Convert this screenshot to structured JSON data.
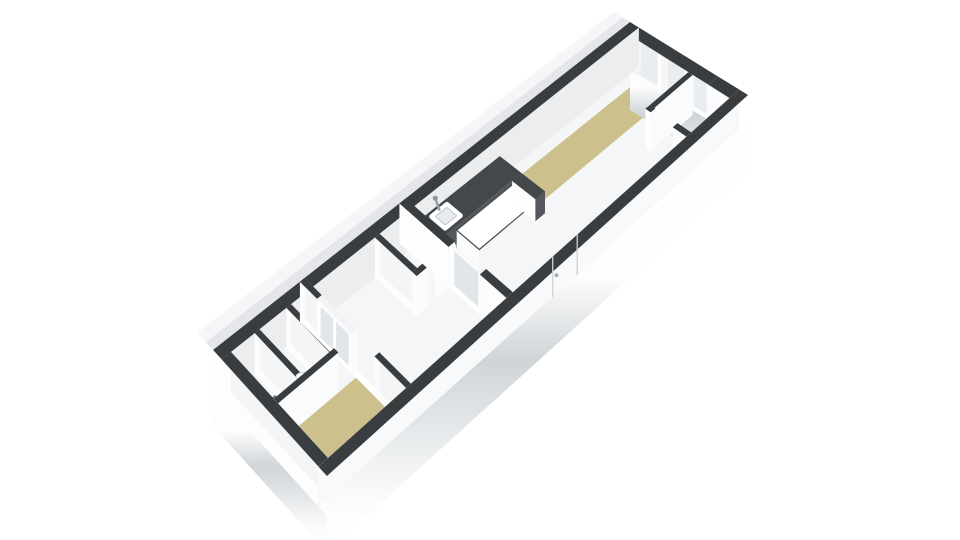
{
  "meta": {
    "view": "3d-floorplan-isometric",
    "background": "#ffffff"
  },
  "rooms": [
    {
      "name": "living-kitchen",
      "floor": "wood-strip-and-white",
      "features": [
        "kitchen-counter",
        "sink",
        "island",
        "glazed-door"
      ]
    },
    {
      "name": "end-room",
      "floor": "white"
    },
    {
      "name": "hallway",
      "floor": "white",
      "features": [
        "interior-window"
      ]
    },
    {
      "name": "wc-mid",
      "floor": "white"
    },
    {
      "name": "bedroom",
      "floor": "wood"
    },
    {
      "name": "bathroom",
      "floor": "white",
      "features": [
        "shower-tray",
        "radiator"
      ]
    },
    {
      "name": "wc-tip",
      "floor": "white",
      "features": [
        "toilet"
      ]
    }
  ],
  "colors": {
    "wall_top": "#3a3d40",
    "face_end": "#fdfdfe",
    "face_end2": "#f3f5f6",
    "face_se": "#fafbfc",
    "face_shade": "#ebedef",
    "floor_white": "#f5f6f7",
    "floor_wood": "#ccc18d",
    "counter_top": "#45484b",
    "counter_face": "#54575b",
    "glass": "#e9edf0",
    "glass2": "#dfe4e8",
    "shower": "#8498bf",
    "shower_edge": "#67799e",
    "band_inner": "#d8dcdf",
    "band_outer": "#eaedef"
  },
  "projection": {
    "u_max": 13.2,
    "v_max": 4,
    "corners": {
      "f00": [
        213,
        390
      ],
      "f10": [
        630,
        62
      ],
      "f11": [
        748,
        135
      ],
      "f01": [
        327,
        516
      ]
    },
    "wall_lift_px": 40,
    "u1_face_max_uc": 5.2,
    "v_face_switch": 2.9
  },
  "draw": [
    {
      "t": "quad",
      "name": "nw-ground-band",
      "pts": [
        [
          0,
          0,
          1
        ],
        [
          13.2,
          0,
          1
        ],
        [
          13.2,
          -0.25,
          1
        ],
        [
          0,
          -0.25,
          1
        ]
      ],
      "fill": "@band_inner",
      "op": 0.7
    },
    {
      "t": "quad",
      "name": "nw-ground-band-outer",
      "pts": [
        [
          0,
          -0.25,
          1
        ],
        [
          13.2,
          -0.25,
          1
        ],
        [
          13.2,
          -0.55,
          1
        ],
        [
          0,
          -0.55,
          1
        ]
      ],
      "fill": "@band_outer",
      "op": 0.5
    },
    {
      "t": "floor",
      "name": "shower-room-floor",
      "u": 0.3,
      "v": 0.3,
      "du": 0.75,
      "dv": 1.5,
      "fill": "@floor_white"
    },
    {
      "t": "floor",
      "name": "wc-room-floor",
      "u": 1.2,
      "v": 0.3,
      "du": 0.85,
      "dv": 1.5,
      "fill": "@floor_white"
    },
    {
      "t": "floor",
      "name": "tip-landing-floor",
      "u": 2.2,
      "v": 0.3,
      "du": 0.55,
      "dv": 1.65,
      "fill": "@floor_white"
    },
    {
      "t": "floor",
      "name": "bedroom-floor",
      "u": 0.3,
      "v": 1.95,
      "du": 2.45,
      "dv": 1.75,
      "fill": "@floor_wood"
    },
    {
      "t": "floor",
      "name": "hall-floor",
      "u": 2.9,
      "v": 0.3,
      "du": 3.0,
      "dv": 3.4,
      "fill": "@floor_white"
    },
    {
      "t": "floor",
      "name": "wc2-floor",
      "u": 5.0,
      "v": 0.3,
      "du": 0.9,
      "dv": 1.3,
      "fill": "@floor_white"
    },
    {
      "t": "floor",
      "name": "living-floor",
      "u": 6.1,
      "v": 0.3,
      "du": 6.8,
      "dv": 3.4,
      "fill": "@floor_white"
    },
    {
      "t": "floor",
      "name": "living-wood-strip",
      "u": 8.8,
      "v": 0.6,
      "du": 4.1,
      "dv": 0.95,
      "fill": "@floor_wood"
    },
    {
      "t": "quad",
      "name": "shower-tray",
      "pts": [
        [
          0.32,
          1.05,
          0
        ],
        [
          1.02,
          1.05,
          0
        ],
        [
          1.02,
          1.65,
          0
        ],
        [
          0.32,
          1.65,
          0
        ]
      ],
      "fill": "@shower",
      "stroke": "@shower_edge",
      "sw": 3
    },
    {
      "t": "dot",
      "name": "shower-drain",
      "p": [
        0.67,
        1.35,
        0
      ],
      "r": 2,
      "fill": "#64769b"
    },
    {
      "t": "quad",
      "name": "ne-skirt",
      "pts": [
        [
          13.2,
          0,
          1
        ],
        [
          13.2,
          4,
          1
        ],
        [
          13.2,
          4,
          -1.2
        ],
        [
          13.2,
          0,
          -1.2
        ]
      ],
      "fill": "url(#gskirt)"
    },
    {
      "t": "glassU",
      "name": "window-glass",
      "u": 13.02,
      "v0": 0.34,
      "v1": 2.95,
      "z0": 0,
      "z1": 0.97,
      "fill": "@glass",
      "op": 0.95,
      "stroke": "#f8fafb",
      "sw": 2
    },
    {
      "t": "quad",
      "name": "window-sill",
      "pts": [
        [
          13.0,
          1.33,
          0
        ],
        [
          13.0,
          2.88,
          0
        ],
        [
          13.0,
          2.88,
          0.12
        ],
        [
          13.0,
          1.33,
          0.12
        ]
      ],
      "fill": "#fbfcfd"
    },
    {
      "t": "wall",
      "id": "window-mullion-1",
      "u": 12.94,
      "v": 0.3,
      "du": 0.22,
      "dv": 0.11,
      "h": 1,
      "top": "#eef0f2",
      "faceU0": "#ffffff",
      "faceV1": "#f4f6f7"
    },
    {
      "t": "wall",
      "id": "window-mullion-2",
      "u": 12.94,
      "v": 1.22,
      "du": 0.22,
      "dv": 0.11,
      "h": 1,
      "top": "#eef0f2",
      "faceU0": "#ffffff",
      "faceV1": "#f4f6f7"
    },
    {
      "t": "wall",
      "id": "window-mullion-3",
      "u": 12.94,
      "v": 2.12,
      "du": 0.22,
      "dv": 0.11,
      "h": 1,
      "top": "#eef0f2",
      "faceU0": "#ffffff",
      "faceV1": "#f4f6f7"
    },
    {
      "t": "wall",
      "id": "window-mullion-4",
      "u": 12.94,
      "v": 2.88,
      "du": 0.22,
      "dv": 0.11,
      "h": 1,
      "top": "#eef0f2",
      "faceU0": "#ffffff",
      "faceV1": "#f4f6f7"
    },
    {
      "t": "wall",
      "id": "wall-ne-solid",
      "u": 12.9,
      "v": 2.99,
      "du": 0.3,
      "dv": 0.71,
      "h": 1
    },
    {
      "t": "wall",
      "id": "wall-ne-lintel",
      "u": 12.9,
      "v": 0.3,
      "du": 0.3,
      "dv": 2.69,
      "h": 1,
      "topOnly": true
    },
    {
      "t": "wall",
      "id": "wall-nw",
      "u": 0,
      "v": 0,
      "du": 13.2,
      "dv": 0.3,
      "h": 1,
      "faceV1": "@face_shade"
    },
    {
      "t": "wall",
      "id": "kitchen-counter",
      "u": 6.15,
      "v": 0.3,
      "du": 2.65,
      "dv": 0.75,
      "h": 0.55,
      "top": "@counter_top",
      "faceV1": "@counter_face",
      "faceU0": "@counter_face"
    },
    {
      "t": "quad",
      "name": "kitchen-sink-rim",
      "pts": [
        [
          6.52,
          0.44,
          0.56
        ],
        [
          7.0,
          0.44,
          0.56
        ],
        [
          7.0,
          0.9,
          0.56
        ],
        [
          6.52,
          0.9,
          0.56
        ]
      ],
      "fill": "#ffffff",
      "stroke": "#ffffff",
      "sw": 5
    },
    {
      "t": "quad",
      "name": "kitchen-sink-basin",
      "pts": [
        [
          6.58,
          0.5,
          0.56
        ],
        [
          6.94,
          0.5,
          0.56
        ],
        [
          6.94,
          0.84,
          0.56
        ],
        [
          6.58,
          0.84,
          0.56
        ]
      ],
      "fill": "#e8ebed",
      "stroke": "#c0c5c8",
      "sw": 1
    },
    {
      "t": "seg",
      "name": "kitchen-faucet",
      "p1": [
        6.76,
        0.44,
        0.58
      ],
      "p2": [
        6.76,
        0.3,
        0.78
      ],
      "stroke": "#9aa0a5",
      "w": 2.5
    },
    {
      "t": "dot",
      "name": "kitchen-faucet-head",
      "p": [
        6.76,
        0.3,
        0.78
      ],
      "r": 2.5,
      "fill": "#8f959a"
    },
    {
      "t": "wall",
      "id": "kitchen-island",
      "u": 6.75,
      "v": 1.05,
      "du": 1.75,
      "dv": 0.78,
      "h": 0.45,
      "top": "#ffffff",
      "topStroke": "#494c4f",
      "faceV1": "#f5f6f7",
      "faceU0": "#fafbfb"
    },
    {
      "t": "wall",
      "id": "kitchen-counter-end",
      "u": 8.5,
      "v": 1.05,
      "du": 0.3,
      "dv": 0.8,
      "h": 0.55,
      "top": "@counter_top",
      "faceV1": "@counter_face"
    },
    {
      "t": "wall",
      "id": "wall-wc2-a",
      "u": 4.85,
      "v": 0.3,
      "du": 0.15,
      "dv": 1.3,
      "h": 1
    },
    {
      "t": "wall",
      "id": "wall-wc2-b",
      "u": 4.85,
      "v": 1.6,
      "du": 0.35,
      "dv": 0.15,
      "h": 1
    },
    {
      "t": "wall",
      "id": "wall-wc2-c",
      "u": 5.55,
      "v": 1.6,
      "du": 0.35,
      "dv": 0.15,
      "h": 1
    },
    {
      "t": "wall",
      "id": "wall-divider-a",
      "u": 5.9,
      "v": 0,
      "du": 0.2,
      "dv": 1.7,
      "h": 1
    },
    {
      "t": "wall",
      "id": "door-post-1",
      "u": 5.94,
      "v": 1.7,
      "du": 0.12,
      "dv": 0.09,
      "h": 1,
      "top": "#f1f3f4",
      "faceU0": "#ffffff"
    },
    {
      "t": "glassU",
      "name": "door-glass",
      "u": 6.0,
      "v0": 1.79,
      "v1": 2.69,
      "z0": 0.02,
      "z1": 0.88,
      "fill": "@glass2",
      "op": 0.9
    },
    {
      "t": "quad",
      "name": "door-top-rail",
      "pts": [
        [
          6.0,
          1.79,
          0.88
        ],
        [
          6.0,
          2.69,
          0.88
        ],
        [
          6.0,
          2.69,
          0.99
        ],
        [
          6.0,
          1.79,
          0.99
        ]
      ],
      "fill": "#fafbfc"
    },
    {
      "t": "wall",
      "id": "door-post-2",
      "u": 5.94,
      "v": 2.69,
      "du": 0.12,
      "dv": 0.09,
      "h": 1,
      "top": "#f1f3f4",
      "faceU0": "#ffffff"
    },
    {
      "t": "wall",
      "id": "wall-divider-b",
      "u": 5.9,
      "v": 2.78,
      "du": 0.2,
      "dv": 0.92,
      "h": 1
    },
    {
      "t": "wall",
      "id": "wall-endroom-long",
      "u": 11.7,
      "v": 2.3,
      "du": 1.2,
      "dv": 0.15,
      "h": 1
    },
    {
      "t": "wall",
      "id": "wall-endroom-a",
      "u": 11.55,
      "v": 2.3,
      "du": 0.15,
      "dv": 0.18,
      "h": 1
    },
    {
      "t": "wall",
      "id": "wall-endroom-b",
      "u": 11.55,
      "v": 3.23,
      "du": 0.15,
      "dv": 0.47,
      "h": 1
    },
    {
      "t": "wall",
      "id": "wall-tip-2",
      "u": 2.05,
      "v": 0.3,
      "du": 0.15,
      "dv": 1.5,
      "h": 1
    },
    {
      "t": "wall",
      "id": "wall-tip-1",
      "u": 1.05,
      "v": 0.3,
      "du": 0.15,
      "dv": 1.5,
      "h": 1
    },
    {
      "t": "wall",
      "id": "wall-tipdiv-a",
      "u": 2.75,
      "v": 0,
      "du": 0.15,
      "dv": 0.6,
      "h": 1
    },
    {
      "t": "wall",
      "id": "tip-window-frame",
      "u": 2.75,
      "v": 0.6,
      "du": 0.15,
      "dv": 1.22,
      "h": 1,
      "top": "#f3f4f5",
      "faceU0": "#ffffff",
      "faceU1": "#fbfcfd"
    },
    {
      "t": "glassU",
      "name": "tip-window-glass",
      "u": 2.75,
      "v0": 0.72,
      "v1": 1.7,
      "z0": 0.12,
      "z1": 0.9,
      "fill": "@glass2",
      "op": 0.92
    },
    {
      "t": "seg",
      "name": "tip-window-mullion",
      "p1": [
        2.75,
        1.21,
        0.12
      ],
      "p2": [
        2.75,
        1.21,
        0.9
      ],
      "stroke": "#ffffff",
      "w": 3
    },
    {
      "t": "wall",
      "id": "wall-tipdiv-b",
      "u": 2.75,
      "v": 2.6,
      "du": 0.15,
      "dv": 1.1,
      "h": 1
    },
    {
      "t": "wall",
      "id": "toilet-tank",
      "u": 1.48,
      "v": 1.42,
      "du": 0.4,
      "dv": 0.3,
      "h": 0.38,
      "top": "#ffffff",
      "topStroke": "#d8dcde",
      "faceU0": "#f6f7f8",
      "faceV1": "#eef0f2"
    },
    {
      "t": "ell",
      "name": "toilet-bowl",
      "p": [
        1.68,
        1.33,
        0.28
      ],
      "rx": 8,
      "ry": 4.5,
      "fill": "#ffffff",
      "stroke": "#d5d9db"
    },
    {
      "t": "wall",
      "id": "radiator",
      "u": 0.34,
      "v": 0.5,
      "du": 0.09,
      "dv": 0.55,
      "h": 0.85,
      "top": "#eceeef",
      "faceU1": "#f4f6f7",
      "faceV1": "#e8eaec"
    },
    {
      "t": "seg",
      "name": "radiator-rail-1",
      "p1": [
        0.4,
        0.52,
        0.3
      ],
      "p2": [
        0.4,
        1.03,
        0.3
      ],
      "stroke": "#dadde0",
      "w": 1.5
    },
    {
      "t": "seg",
      "name": "radiator-rail-2",
      "p1": [
        0.4,
        0.52,
        0.5
      ],
      "p2": [
        0.4,
        1.03,
        0.5
      ],
      "stroke": "#dadde0",
      "w": 1.5
    },
    {
      "t": "seg",
      "name": "radiator-rail-3",
      "p1": [
        0.4,
        0.52,
        0.68
      ],
      "p2": [
        0.4,
        1.03,
        0.68
      ],
      "stroke": "#dadde0",
      "w": 1.5
    },
    {
      "t": "wall",
      "id": "wall-bedroom",
      "u": 0.3,
      "v": 1.8,
      "du": 1.9,
      "dv": 0.15,
      "h": 1
    },
    {
      "t": "quad",
      "name": "sw-skirt",
      "pts": [
        [
          0,
          0,
          1
        ],
        [
          0,
          4,
          1
        ],
        [
          0,
          4,
          -0.9
        ],
        [
          0,
          0,
          -0.9
        ]
      ],
      "fill": "url(#gskirt)"
    },
    {
      "t": "wall",
      "id": "wall-sw",
      "u": 0,
      "v": 0.3,
      "du": 0.3,
      "dv": 3.4,
      "h": 1
    },
    {
      "t": "quad",
      "name": "se-skirt",
      "pts": [
        [
          0,
          4,
          1
        ],
        [
          13.2,
          4,
          1
        ],
        [
          13.2,
          4,
          -0.9
        ],
        [
          0,
          4,
          -0.9
        ]
      ],
      "fill": "url(#gskirt)"
    },
    {
      "t": "wall",
      "id": "wall-se",
      "u": 0,
      "v": 3.7,
      "du": 13.2,
      "dv": 0.3,
      "h": 1,
      "faceV0": "#f8f9fa"
    },
    {
      "t": "seg",
      "name": "se-door-seam-1",
      "p1": [
        7.35,
        3.7,
        0
      ],
      "p2": [
        7.35,
        3.7,
        1
      ],
      "stroke": "#ced2d5",
      "w": 1.3
    },
    {
      "t": "seg",
      "name": "se-door-seam-2",
      "p1": [
        8.12,
        3.7,
        0
      ],
      "p2": [
        8.12,
        3.7,
        1
      ],
      "stroke": "#ced2d5",
      "w": 1.3
    },
    {
      "t": "dot",
      "name": "se-door-handle",
      "p": [
        7.47,
        3.7,
        0.45
      ],
      "r": 2,
      "fill": "#a7adb1"
    }
  ]
}
